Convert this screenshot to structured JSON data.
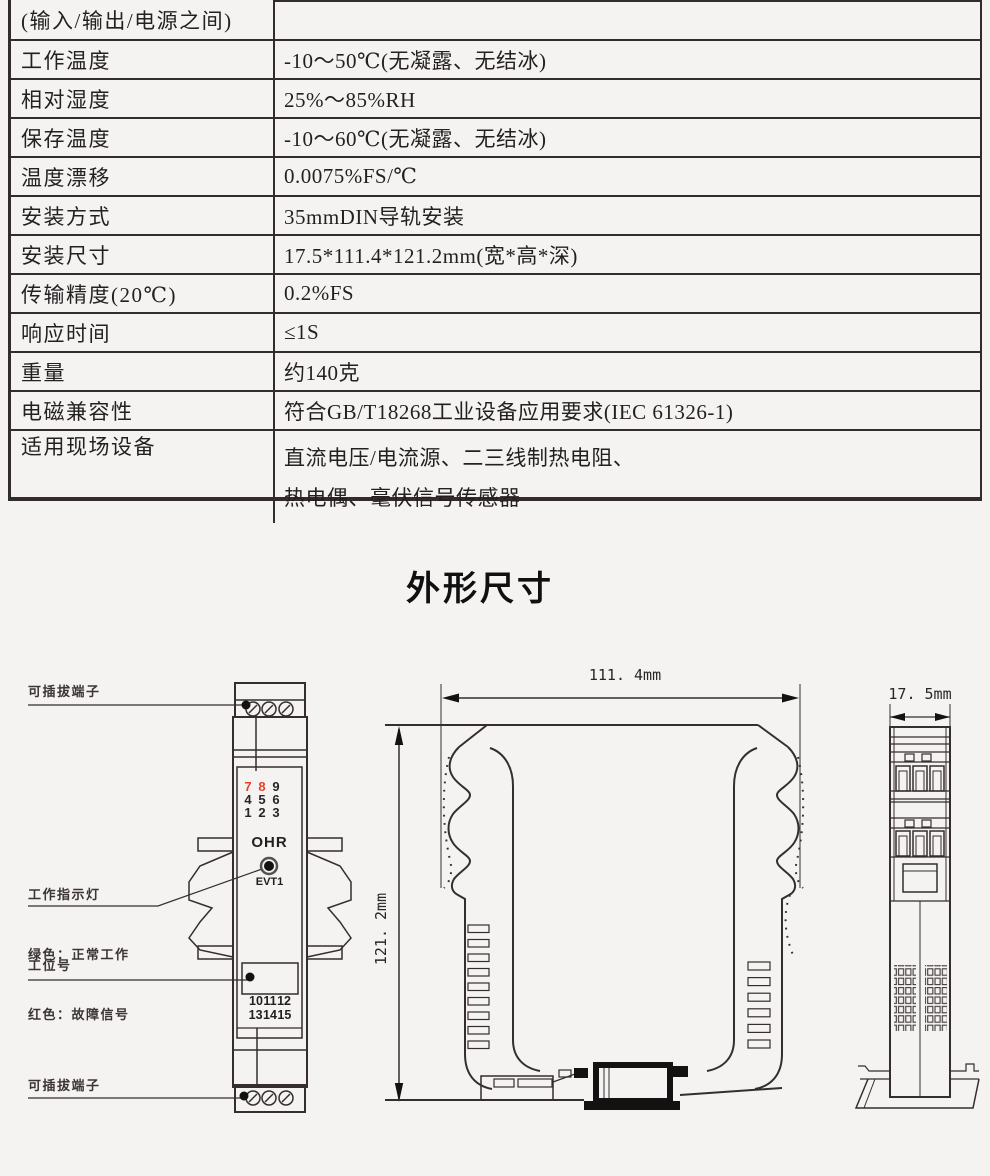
{
  "spec_table": {
    "rows": [
      {
        "label": "(输入/输出/电源之间)",
        "value": ""
      },
      {
        "label": "工作温度",
        "value": "-10～50℃(无凝露、无结冰)"
      },
      {
        "label": "相对湿度",
        "value": "25%～85%RH"
      },
      {
        "label": "保存温度",
        "value": "-10～60℃(无凝露、无结冰)"
      },
      {
        "label": "温度漂移",
        "value": "0.0075%FS/℃"
      },
      {
        "label": "安装方式",
        "value": "35mmDIN导轨安装"
      },
      {
        "label": "安装尺寸",
        "value": "17.5*111.4*121.2mm(宽*高*深)"
      },
      {
        "label": "传输精度(20℃)",
        "value": "0.2%FS"
      },
      {
        "label": "响应时间",
        "value": "≤1S"
      },
      {
        "label": "重量",
        "value": "约140克"
      },
      {
        "label": "电磁兼容性",
        "value": "符合GB/T18268工业设备应用要求(IEC 61326-1)"
      },
      {
        "label": "适用现场设备",
        "value": "直流电压/电流源、二三线制热电阻、",
        "value2": "热电偶、毫伏信号传感器"
      }
    ]
  },
  "section_title": "外形尺寸",
  "diagram": {
    "labels": {
      "pluggable_terminal_top": "可插拔端子",
      "indicator_line1": "工作指示灯",
      "indicator_line2": "绿色：正常工作",
      "indicator_line3": "红色：故障信号",
      "station_number": "工位号",
      "pluggable_terminal_bottom": "可插拔端子"
    },
    "device": {
      "brand": "OHR",
      "model": "EVT1",
      "terminals_top": [
        "7",
        "8",
        "9",
        "4",
        "5",
        "6",
        "1",
        "2",
        "3"
      ],
      "terminals_bottom_row1": "10 11 12",
      "terminals_bottom_row2": "13 14 15"
    },
    "dimensions": {
      "width": "111. 4mm",
      "height": "121. 2mm",
      "depth": "17. 5mm"
    },
    "colors": {
      "line": "#352d2e",
      "red_digit": "#e8402a",
      "background": "#f4f3f1"
    }
  }
}
